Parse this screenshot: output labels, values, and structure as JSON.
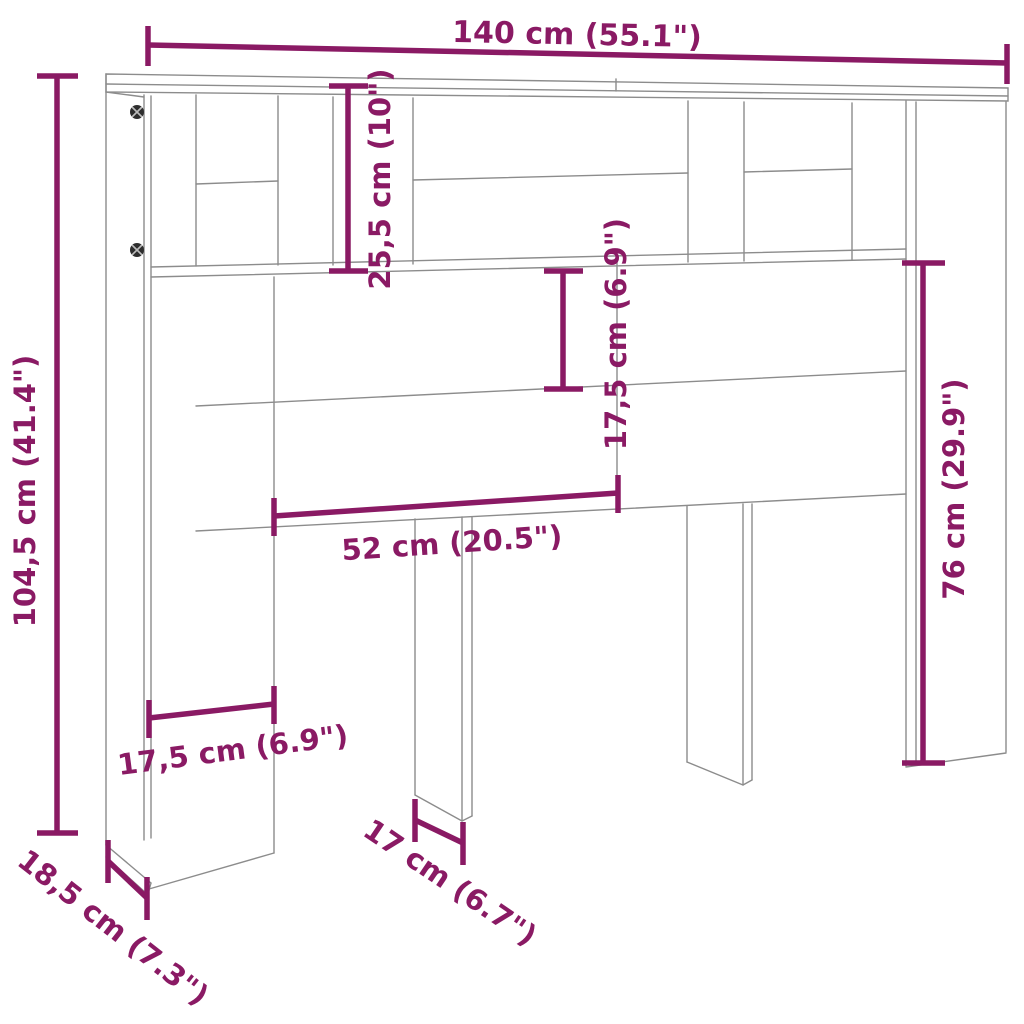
{
  "diagram": {
    "type": "furniture-dimension-diagram",
    "subject": "headboard-cabinet line drawing with measurements",
    "background_color": "#FFFFFF",
    "accent_color": "#8A1A64",
    "line_color": "#8C8C8C",
    "screw_color": "#2E2E2E",
    "labels": {
      "overall_width": "140 cm (55.1\")",
      "overall_height": "104,5 cm (41.4\")",
      "top_compartment_height": "25,5 cm (10\")",
      "upper_panel_height": "17,5 cm (6.9\")",
      "center_opening_width": "52 cm (20.5\")",
      "lower_clearance_height": "76 cm (29.9\")",
      "side_column_width": "17,5 cm (6.9\")",
      "center_leg_width": "17 cm (6.7\")",
      "depth": "18,5 cm (7.3\")"
    }
  }
}
